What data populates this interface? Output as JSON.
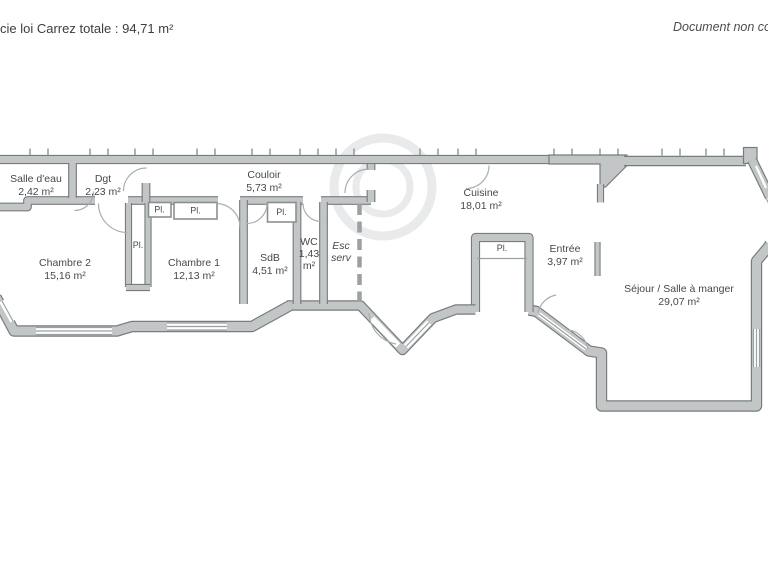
{
  "header": {
    "left_text": "cie loi Carrez totale : 94,71 m²",
    "right_text": "Document non con"
  },
  "rooms": {
    "salle_deau": {
      "name": "Salle d'eau",
      "area": "2,42 m²"
    },
    "dgt": {
      "name": "Dgt",
      "area": "2,23 m²"
    },
    "couloir": {
      "name": "Couloir",
      "area": "5,73 m²"
    },
    "cuisine": {
      "name": "Cuisine",
      "area": "18,01 m²"
    },
    "chambre2": {
      "name": "Chambre 2",
      "area": "15,16 m²"
    },
    "chambre1": {
      "name": "Chambre 1",
      "area": "12,13 m²"
    },
    "sdb": {
      "name": "SdB",
      "area": "4,51 m²"
    },
    "wc": {
      "name": "WC",
      "area_value": "1,43",
      "area_unit": "m²"
    },
    "esc_serv": {
      "name_line1": "Esc",
      "name_line2": "serv"
    },
    "entree": {
      "name": "Entrée",
      "area": "3,97 m²"
    },
    "sejour": {
      "name": "Séjour / Salle à manger",
      "area": "29,07 m²"
    }
  },
  "closets": {
    "label": "Pl."
  },
  "colors": {
    "wall_fill": "#c3c6c7",
    "wall_outline": "#797c7e",
    "label_text": "#45494c",
    "watermark": "#e8eaeb",
    "background": "#ffffff"
  }
}
